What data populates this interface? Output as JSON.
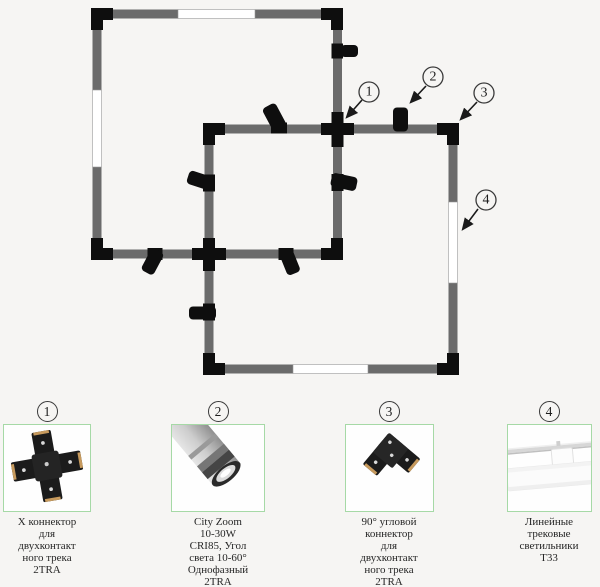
{
  "colors": {
    "background": "#f6f5f3",
    "track_gray": "#6b6b6b",
    "connector_black": "#0e0e0e",
    "light_segment_white": "#ffffff",
    "photo_border_green": "#a6d9a6",
    "text": "#262626"
  },
  "diagram": {
    "callouts": [
      {
        "label": "1"
      },
      {
        "label": "2"
      },
      {
        "label": "3"
      },
      {
        "label": "4"
      }
    ]
  },
  "products": [
    {
      "number": "1",
      "name": "x-connector",
      "caption": "Х коннектор\nдля\nдвухконтакт\nного трека\n2TRA"
    },
    {
      "number": "2",
      "name": "city-zoom-spotlight",
      "caption": "City Zoom\n10-30W\nCRI85, Угол\nсвета 10-60°\nОднофазный\n2TRA"
    },
    {
      "number": "3",
      "name": "corner-connector",
      "caption": "90° угловой\nконнектор\nдля\nдвухконтакт\nного трека\n2TRA"
    },
    {
      "number": "4",
      "name": "linear-track-light",
      "caption": "Линейные\nтрековые\nсветильники\nТ33"
    }
  ]
}
